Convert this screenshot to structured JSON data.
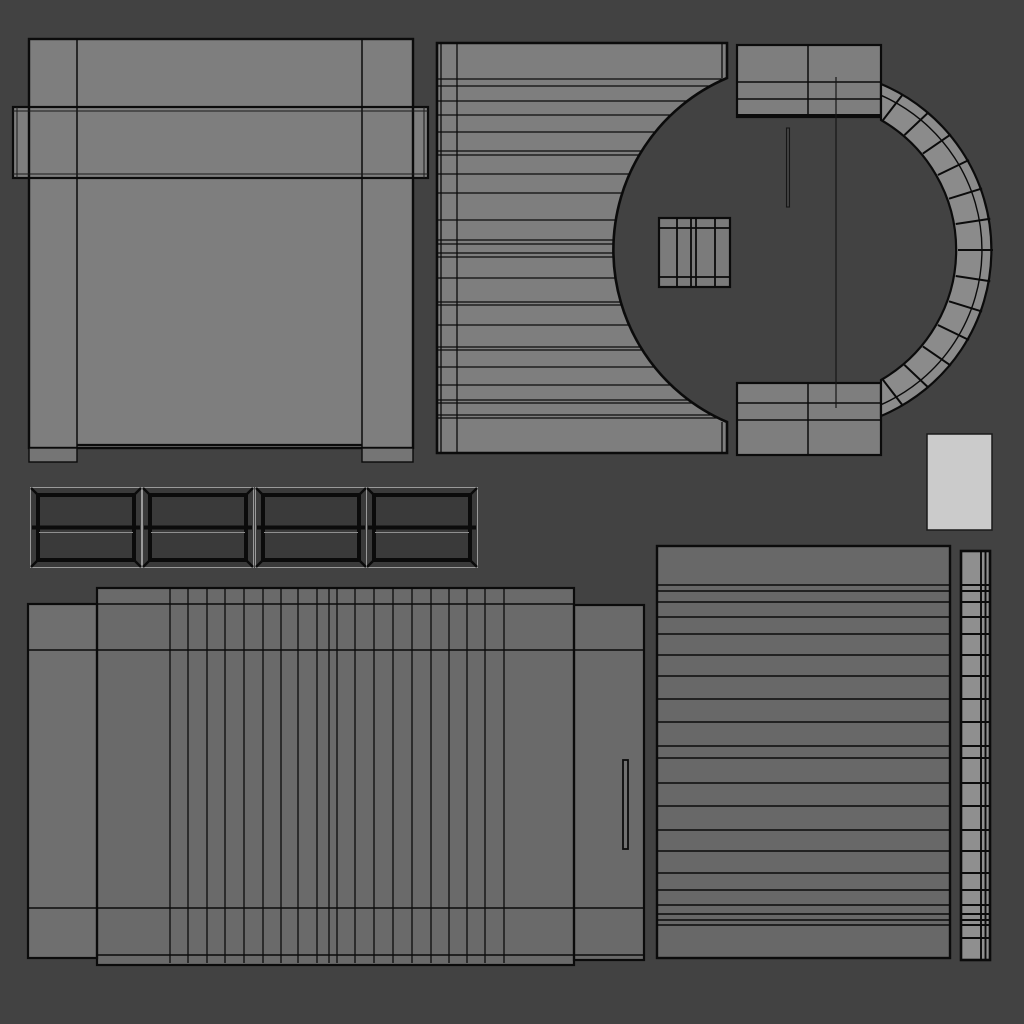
{
  "scene": {
    "type": "uv-unwrap-wireframe-viewport",
    "background": "#424242",
    "wire_color": "#0b0b0b",
    "canvas_px": "1024x1024"
  },
  "islands": [
    {
      "name": "banded-panel",
      "fill": "#7e7e7e",
      "tab_fill": "#757575",
      "x": 13,
      "y": 39,
      "w": 415,
      "h": 424,
      "columns": 3,
      "band_y": 107
    },
    {
      "name": "arch-wall",
      "fill": "#7e7e7e",
      "x": 437,
      "y": 43,
      "w": 291,
      "h": 410,
      "slat_lines": 26
    },
    {
      "name": "arch-ring",
      "fill": "#8b8b8b",
      "block_fill": "#7e7e7e",
      "x": 737,
      "y": 45,
      "w": 256,
      "h": 410,
      "segments": 14
    },
    {
      "name": "mullioned-panel",
      "fill": "#7b7b7b",
      "x": 659,
      "y": 218,
      "w": 71,
      "h": 69,
      "mullions": 4
    },
    {
      "name": "blank-swatch",
      "fill": "#cbcbcb",
      "x": 927,
      "y": 434,
      "w": 65,
      "h": 96
    },
    {
      "name": "bevel-frame-strip",
      "fill": "#3a3a3a",
      "frame_count": 4,
      "x": 30,
      "y": 487,
      "w": 448,
      "h": 81
    },
    {
      "name": "plank-door",
      "fill": "#6a6a6a",
      "side_fill": "#6f6f6f",
      "x": 28,
      "y": 588,
      "w": 616,
      "h": 377,
      "plank_lines": 20
    },
    {
      "name": "slat-board",
      "fill": "#686868",
      "x": 657,
      "y": 546,
      "w": 293,
      "h": 412,
      "slat_lines": 21
    },
    {
      "name": "segmented-strip",
      "fill": "#8f8f8f",
      "x": 961,
      "y": 551,
      "w": 29,
      "h": 409,
      "cell_lines": 22
    }
  ]
}
